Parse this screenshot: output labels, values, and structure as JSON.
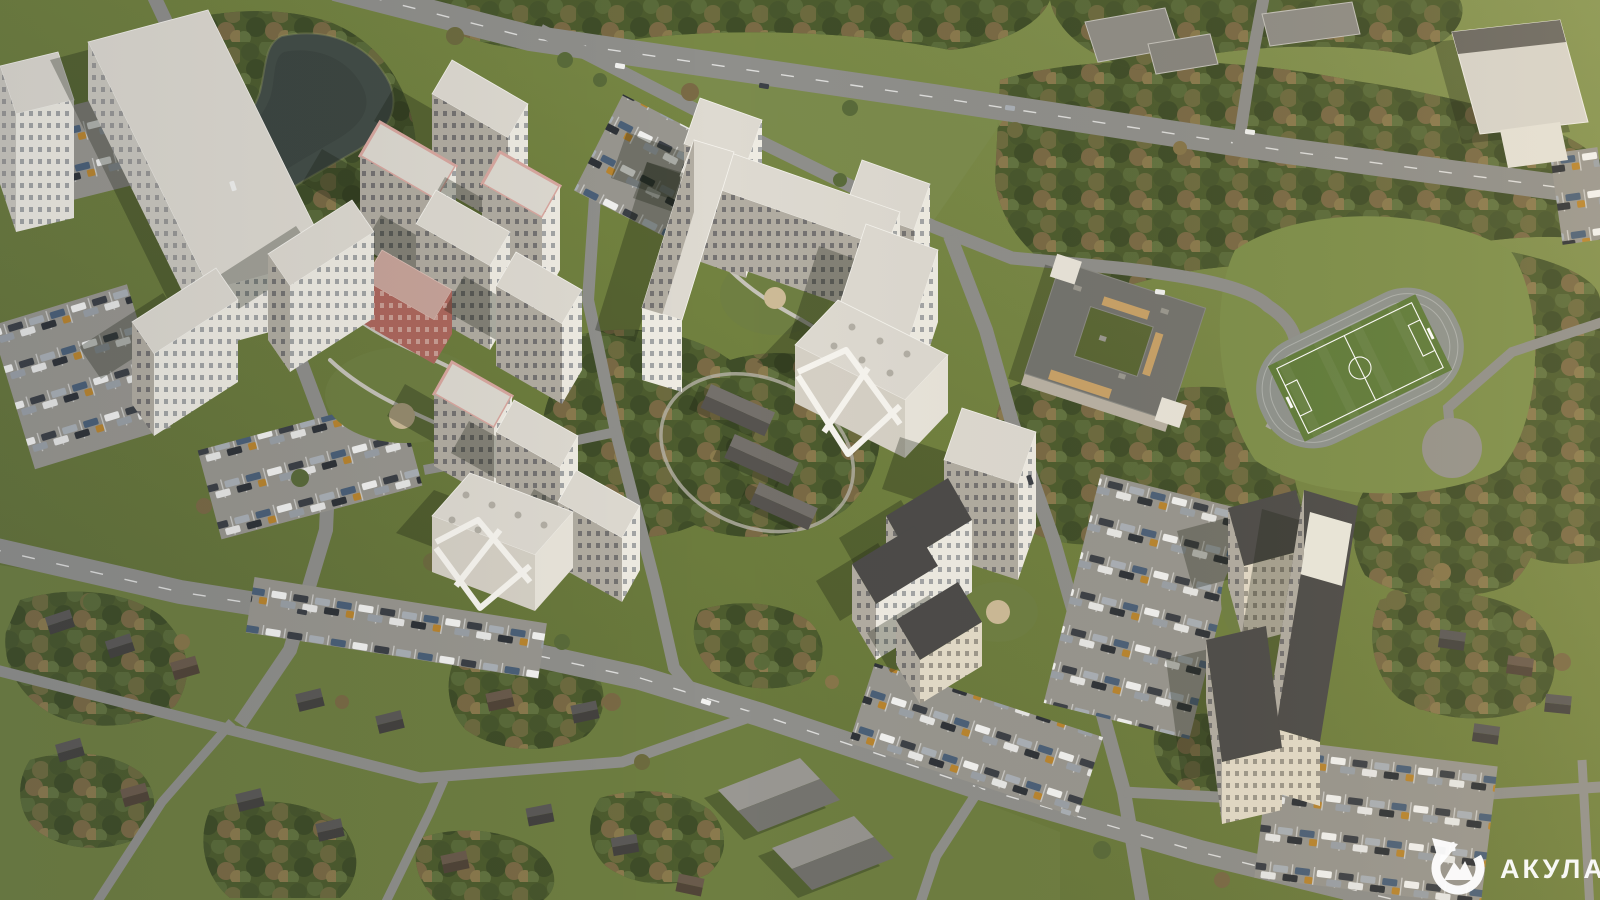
{
  "watermark": {
    "label": "АКУЛА",
    "icon": "shark-drop-icon"
  },
  "palette": {
    "grass": "#71813f",
    "grassDark": "#5c6b37",
    "grassLight": "#879653",
    "lawn": "#6f7f42",
    "meadow": "#7d8f4a",
    "forest": "#4d5c2e",
    "treeMid": "#5a6b3a",
    "road": "#8f8f8b",
    "parking": "#98968f",
    "water": "#434d47",
    "buildingBright": "#efece3",
    "buildingShade": "#b2ada2",
    "roofLight": "#dedad1",
    "roofDark": "#4c4b49",
    "brick": "#ad675d",
    "pink": "#d9a8a0",
    "cream": "#e4dcc9",
    "beige": "#c9a268",
    "fieldGreen": "#5f7c3a",
    "track": "#8e938e"
  }
}
